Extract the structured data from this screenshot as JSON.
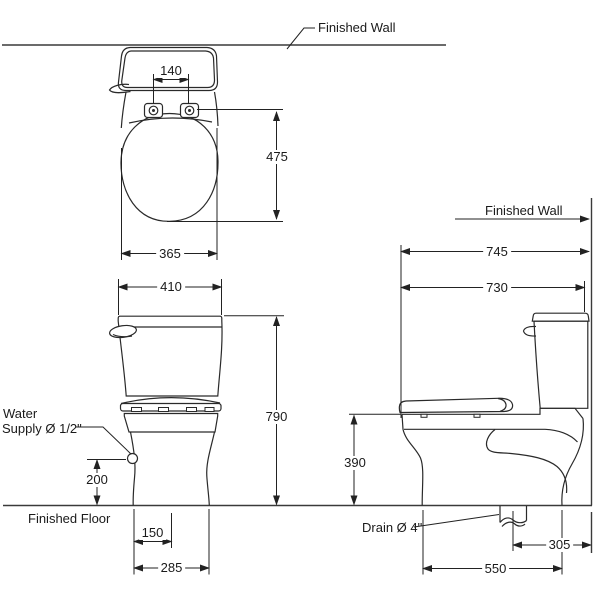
{
  "drawing": {
    "subject": "two-piece toilet installation dimension drawing",
    "views": [
      "plan view",
      "front view",
      "side view"
    ],
    "background_color": "#ffffff",
    "line_color": "#222222"
  },
  "labels": {
    "finished_wall_top": "Finished Wall",
    "finished_wall_side": "Finished Wall",
    "finished_floor": "Finished Floor",
    "water_line1": "Water",
    "water_line2": "Supply Ø 1/2\"",
    "drain": "Drain Ø 4\""
  },
  "dimensions": {
    "plan": {
      "hinge_spacing": "140",
      "seat_length": "475",
      "seat_width": "365"
    },
    "front": {
      "tank_width": "410",
      "overall_height": "790",
      "supply_height": "200",
      "supply_offset": "150",
      "base_width": "285"
    },
    "side": {
      "overall_depth": "745",
      "tank_depth": "730",
      "bowl_height": "390",
      "drain_offset": "305",
      "base_depth": "550"
    }
  }
}
